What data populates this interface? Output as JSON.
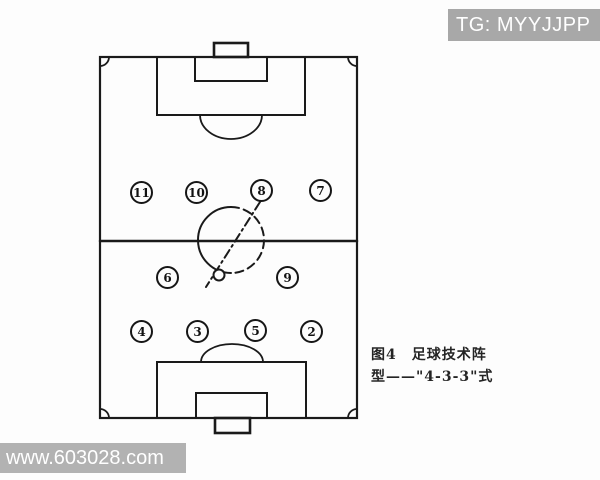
{
  "watermarks": {
    "top_right": {
      "text": "TG: MYYJJPP",
      "bg_color": "#a8a8a8",
      "text_color": "#ffffff"
    },
    "bottom_left": {
      "text": "www.603028.com",
      "bg_color": "#b2b2b2",
      "text_color": "#ffffff"
    }
  },
  "caption": {
    "line1": "图4　足球技术阵",
    "line2": "型——\"4-3-3\"式"
  },
  "diagram": {
    "type": "soccer-formation",
    "formation": "4-3-3",
    "line_color": "#1a1a1a",
    "players": [
      {
        "number": "11"
      },
      {
        "number": "10"
      },
      {
        "number": "8"
      },
      {
        "number": "7"
      },
      {
        "number": "6"
      },
      {
        "number": "9"
      },
      {
        "number": "4"
      },
      {
        "number": "3"
      },
      {
        "number": "5"
      },
      {
        "number": "2"
      }
    ]
  }
}
